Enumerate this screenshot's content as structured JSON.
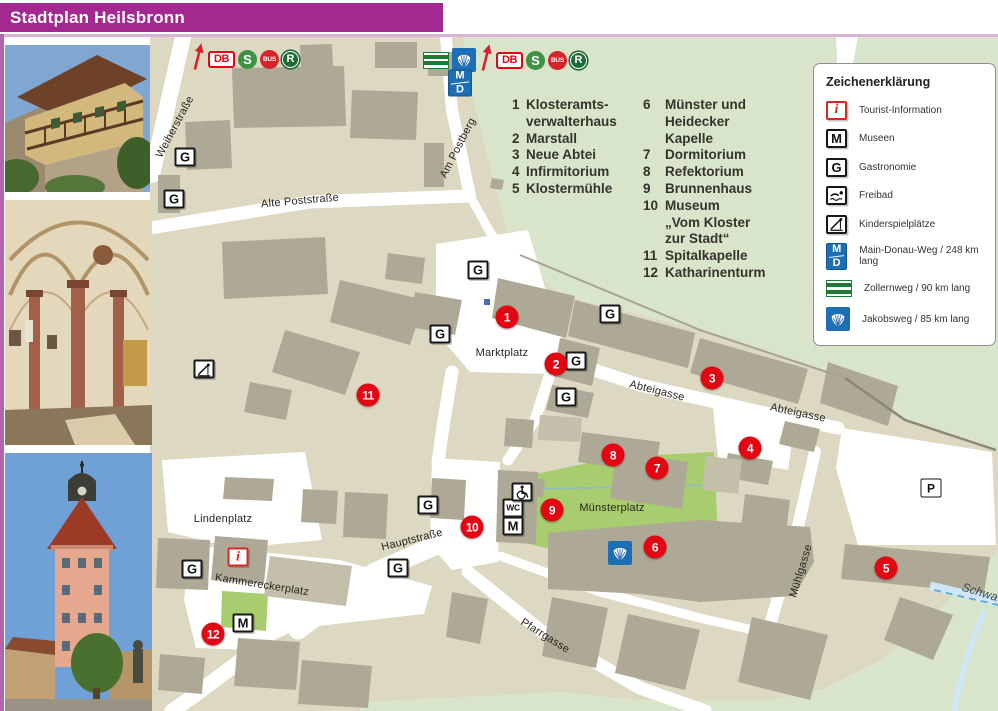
{
  "page": {
    "title": "Stadtplan Heilsbronn"
  },
  "colors": {
    "header": "#A32890",
    "marker_red": "#E30613",
    "lawn_green": "#A7CD6E",
    "forest_green": "#D8E5CA",
    "parcel_beige": "#DCD8C2",
    "building_grey": "#AEA996",
    "route_blue": "#1D6FB5",
    "sbahn_green": "#3F9144",
    "bus_red": "#D8232A",
    "header_pink_border": "#B464AC"
  },
  "icon_text": {
    "G": "G",
    "M": "M",
    "P": "P",
    "WC": "WC",
    "i": "i",
    "DB": "DB",
    "S": "S",
    "BUS": "BUS",
    "R": "R",
    "MD": [
      "M",
      "D"
    ]
  },
  "poi_list": {
    "columns": [
      {
        "items": [
          {
            "num": "1",
            "label": "Klosteramts-\nverwalterhaus"
          },
          {
            "num": "2",
            "label": "Marstall"
          },
          {
            "num": "3",
            "label": "Neue Abtei"
          },
          {
            "num": "4",
            "label": "Infirmitorium"
          },
          {
            "num": "5",
            "label": "Klostermühle"
          }
        ]
      },
      {
        "items": [
          {
            "num": "6",
            "label": "Münster und\nHeidecker Kapelle"
          },
          {
            "num": "7",
            "label": "Dormitorium"
          },
          {
            "num": "8",
            "label": "Refektorium"
          },
          {
            "num": "9",
            "label": "Brunnenhaus"
          },
          {
            "num": "10",
            "label": "Museum\n„Vom Kloster zur Stadt“"
          },
          {
            "num": "11",
            "label": "Spitalkapelle"
          },
          {
            "num": "12",
            "label": "Katharinenturm"
          }
        ]
      }
    ]
  },
  "legend": {
    "title": "Zeichenerklärung",
    "items": [
      {
        "icon": "i",
        "label": "Tourist-Information"
      },
      {
        "icon": "M",
        "label": "Museen"
      },
      {
        "icon": "G",
        "label": "Gastronomie"
      },
      {
        "icon": "FREIBAD",
        "label": "Freibad"
      },
      {
        "icon": "SLIDE",
        "label": "Kinderspielplätze"
      },
      {
        "icon": "MD",
        "label": "Main-Donau-Weg / 248 km lang"
      },
      {
        "icon": "ZOLLERN",
        "label": "Zollernweg / 90 km lang"
      },
      {
        "icon": "SHELL",
        "label": "Jakobsweg / 85 km lang"
      }
    ]
  },
  "transit": {
    "groups": [
      {
        "x": 191,
        "y": 46,
        "icons": [
          "ARROW",
          "DB",
          "S",
          "BUS",
          "R"
        ]
      },
      {
        "x": 423,
        "y": 47,
        "icons": [
          "ZOLLERN",
          "SHELL",
          "ARROW",
          "DB",
          "S",
          "BUS",
          "R"
        ],
        "below": {
          "icon": "MD",
          "x": 460,
          "y": 83
        }
      }
    ]
  },
  "map": {
    "street_labels": [
      {
        "text": "Weiherstraße",
        "x": 175,
        "y": 127,
        "rot": -62
      },
      {
        "text": "Am Postberg",
        "x": 458,
        "y": 148,
        "rot": -63
      },
      {
        "text": "Alte Poststraße",
        "x": 300,
        "y": 201,
        "rot": -5
      },
      {
        "text": "Marktplatz",
        "x": 502,
        "y": 353,
        "rot": 0
      },
      {
        "text": "Abteigasse",
        "x": 657,
        "y": 391,
        "rot": 14
      },
      {
        "text": "Abteigasse",
        "x": 798,
        "y": 413,
        "rot": 12
      },
      {
        "text": "Münsterplatz",
        "x": 612,
        "y": 508,
        "rot": 0
      },
      {
        "text": "Hauptstraße",
        "x": 412,
        "y": 540,
        "rot": -14
      },
      {
        "text": "Lindenplatz",
        "x": 223,
        "y": 519,
        "rot": 0
      },
      {
        "text": "Kammereckerplatz",
        "x": 262,
        "y": 585,
        "rot": 9
      },
      {
        "text": "Mühlgasse",
        "x": 801,
        "y": 571,
        "rot": -73
      },
      {
        "text": "Pfarrgasse",
        "x": 545,
        "y": 636,
        "rot": 32
      },
      {
        "text": "Schwa",
        "x": 980,
        "y": 592,
        "rot": 17,
        "water": true
      }
    ],
    "markers": [
      {
        "n": "1",
        "x": 507,
        "y": 317
      },
      {
        "n": "2",
        "x": 556,
        "y": 364
      },
      {
        "n": "3",
        "x": 712,
        "y": 378
      },
      {
        "n": "4",
        "x": 750,
        "y": 448
      },
      {
        "n": "5",
        "x": 886,
        "y": 568
      },
      {
        "n": "6",
        "x": 655,
        "y": 547
      },
      {
        "n": "7",
        "x": 657,
        "y": 468
      },
      {
        "n": "8",
        "x": 613,
        "y": 455
      },
      {
        "n": "9",
        "x": 552,
        "y": 510
      },
      {
        "n": "10",
        "x": 472,
        "y": 527
      },
      {
        "n": "11",
        "x": 368,
        "y": 395
      },
      {
        "n": "12",
        "x": 213,
        "y": 634
      }
    ],
    "badges": [
      {
        "t": "G",
        "x": 185,
        "y": 157
      },
      {
        "t": "G",
        "x": 174,
        "y": 199
      },
      {
        "t": "G",
        "x": 478,
        "y": 270
      },
      {
        "t": "G",
        "x": 610,
        "y": 314
      },
      {
        "t": "G",
        "x": 576,
        "y": 361
      },
      {
        "t": "G",
        "x": 566,
        "y": 397
      },
      {
        "t": "G",
        "x": 440,
        "y": 334
      },
      {
        "t": "G",
        "x": 428,
        "y": 505
      },
      {
        "t": "G",
        "x": 398,
        "y": 568
      },
      {
        "t": "G",
        "x": 192,
        "y": 569
      },
      {
        "t": "M",
        "x": 513,
        "y": 526
      },
      {
        "t": "M",
        "x": 243,
        "y": 623
      },
      {
        "t": "i",
        "x": 238,
        "y": 557
      },
      {
        "t": "P",
        "x": 931,
        "y": 488
      },
      {
        "t": "WC",
        "x": 513,
        "y": 508
      },
      {
        "t": "WHEELCHAIR",
        "x": 522,
        "y": 492
      },
      {
        "t": "SHELL",
        "x": 620,
        "y": 553
      },
      {
        "t": "SLIDE",
        "x": 204,
        "y": 369
      },
      {
        "t": "DOT",
        "x": 487,
        "y": 302
      }
    ]
  }
}
